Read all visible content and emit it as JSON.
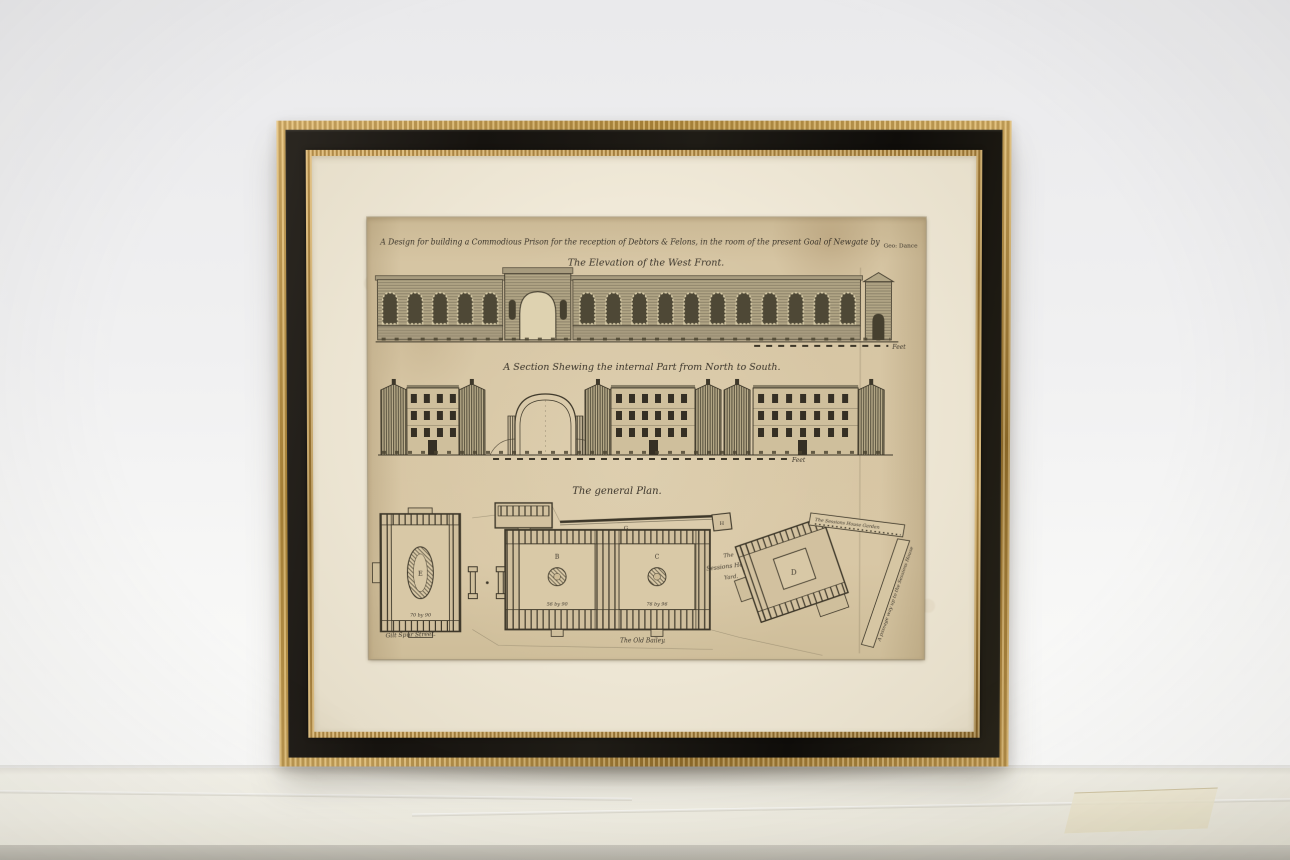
{
  "artwork": {
    "header": {
      "title_script": "A Design for building a Commodious Prison for the reception of Debtors & Felons, in the room of the present Goal of Newgate by",
      "signature": "Geo: Dance"
    },
    "elevation": {
      "caption": "The Elevation of the West Front.",
      "scale_label": "Feet"
    },
    "section": {
      "caption": "A Section Shewing the internal Part from North to South.",
      "scale_label": "Feet"
    },
    "plan": {
      "caption": "The general Plan.",
      "labels": {
        "street_left": "Gilt Spur Street.",
        "street_bottom": "The Old Bailey.",
        "yard_l1": "The",
        "yard_l2": "Sessions House",
        "yard_l3": "Yard.",
        "garden": "The Sessions House Garden",
        "passage": "A passage way up to the Sessions House",
        "block_e": "E",
        "court_b": "B",
        "court_c": "C",
        "block_d": "D",
        "wall_g": "G",
        "lodge_h": "H",
        "dim_e": "70 by 90",
        "dim_b": "56 by 90",
        "dim_c": "76 by 96"
      }
    },
    "colors": {
      "frame_gold": "#bf9a52",
      "frame_black": "#1b1815",
      "mat_cream": "#eae3d0",
      "paper_tan": "#d4c3a1",
      "ink": "#3a342a",
      "backdrop": "#f0f0f1"
    }
  }
}
